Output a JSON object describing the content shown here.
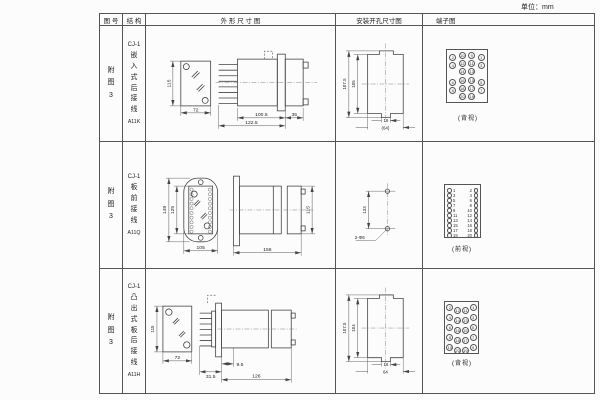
{
  "unit_label": "单位：mm",
  "headers": {
    "fig": "图 号",
    "structure": "结 构",
    "outline": "外 形 尺 寸 图",
    "install": "安装开孔尺寸图",
    "terminal": "端子图"
  },
  "rows": [
    {
      "fig_no": "附\n图\n3",
      "model": "CJ-1",
      "type_chars": "嵌\n入\n式\n后\n接\n线",
      "code": "A11K",
      "outline": {
        "height": "115",
        "width": "72",
        "depth_body": "100.5",
        "depth_rear": "35",
        "depth_total": "122.5"
      },
      "install": {
        "outer": "107.5",
        "inner": "105",
        "slot": "16",
        "width": "(64)"
      },
      "terminal": {
        "label": "(背视)",
        "grid": [
          [
            "2",
            "10",
            "9",
            "1"
          ],
          [
            "4",
            "12",
            "11",
            "3"
          ],
          [
            "",
            "14",
            "13",
            ""
          ],
          [
            "6",
            "16",
            "15",
            "5"
          ],
          [
            "8",
            "18",
            "17",
            "7"
          ],
          [
            "",
            "20",
            "19",
            ""
          ]
        ]
      }
    },
    {
      "fig_no": "附\n图\n3",
      "model": "CJ-1",
      "type_chars": "板\n前\n接\n线",
      "code": "A11Q",
      "outline": {
        "outer_h": "149",
        "inner_h": "125",
        "width": "105",
        "depth": "156",
        "side_h": "115"
      },
      "install": {
        "pitch": "133",
        "holes": "2-Φ6"
      },
      "terminal": {
        "label": "(前视)",
        "pairs": [
          [
            "1",
            "2"
          ],
          [
            "3",
            "4"
          ],
          [
            "5",
            "6"
          ],
          [
            "7",
            "8"
          ],
          [
            "9",
            "10"
          ],
          [
            "11",
            "12"
          ],
          [
            "13",
            "14"
          ],
          [
            "15",
            "16"
          ],
          [
            "17",
            "18"
          ],
          [
            "19",
            "20"
          ]
        ]
      }
    },
    {
      "fig_no": "附\n图\n3",
      "model": "CJ-1",
      "type_chars": "凸\n出\n式\n板\n后\n接\n线",
      "code": "A11H",
      "outline": {
        "height": "115",
        "width": "72",
        "offset": "9.5",
        "pin_len": "31.5",
        "depth": "126"
      },
      "install": {
        "outer": "107.5",
        "inner": "104",
        "slot": "16",
        "width": "64"
      },
      "terminal": {
        "label": "(背视)",
        "grid": [
          [
            "2",
            "12",
            "11",
            "1"
          ],
          [
            "4",
            "14",
            "13",
            "3"
          ],
          [
            "6",
            "16",
            "15",
            "5"
          ],
          [
            "8",
            "18",
            "17",
            "7"
          ],
          [
            "10",
            "20",
            "19",
            "9"
          ]
        ]
      }
    }
  ]
}
